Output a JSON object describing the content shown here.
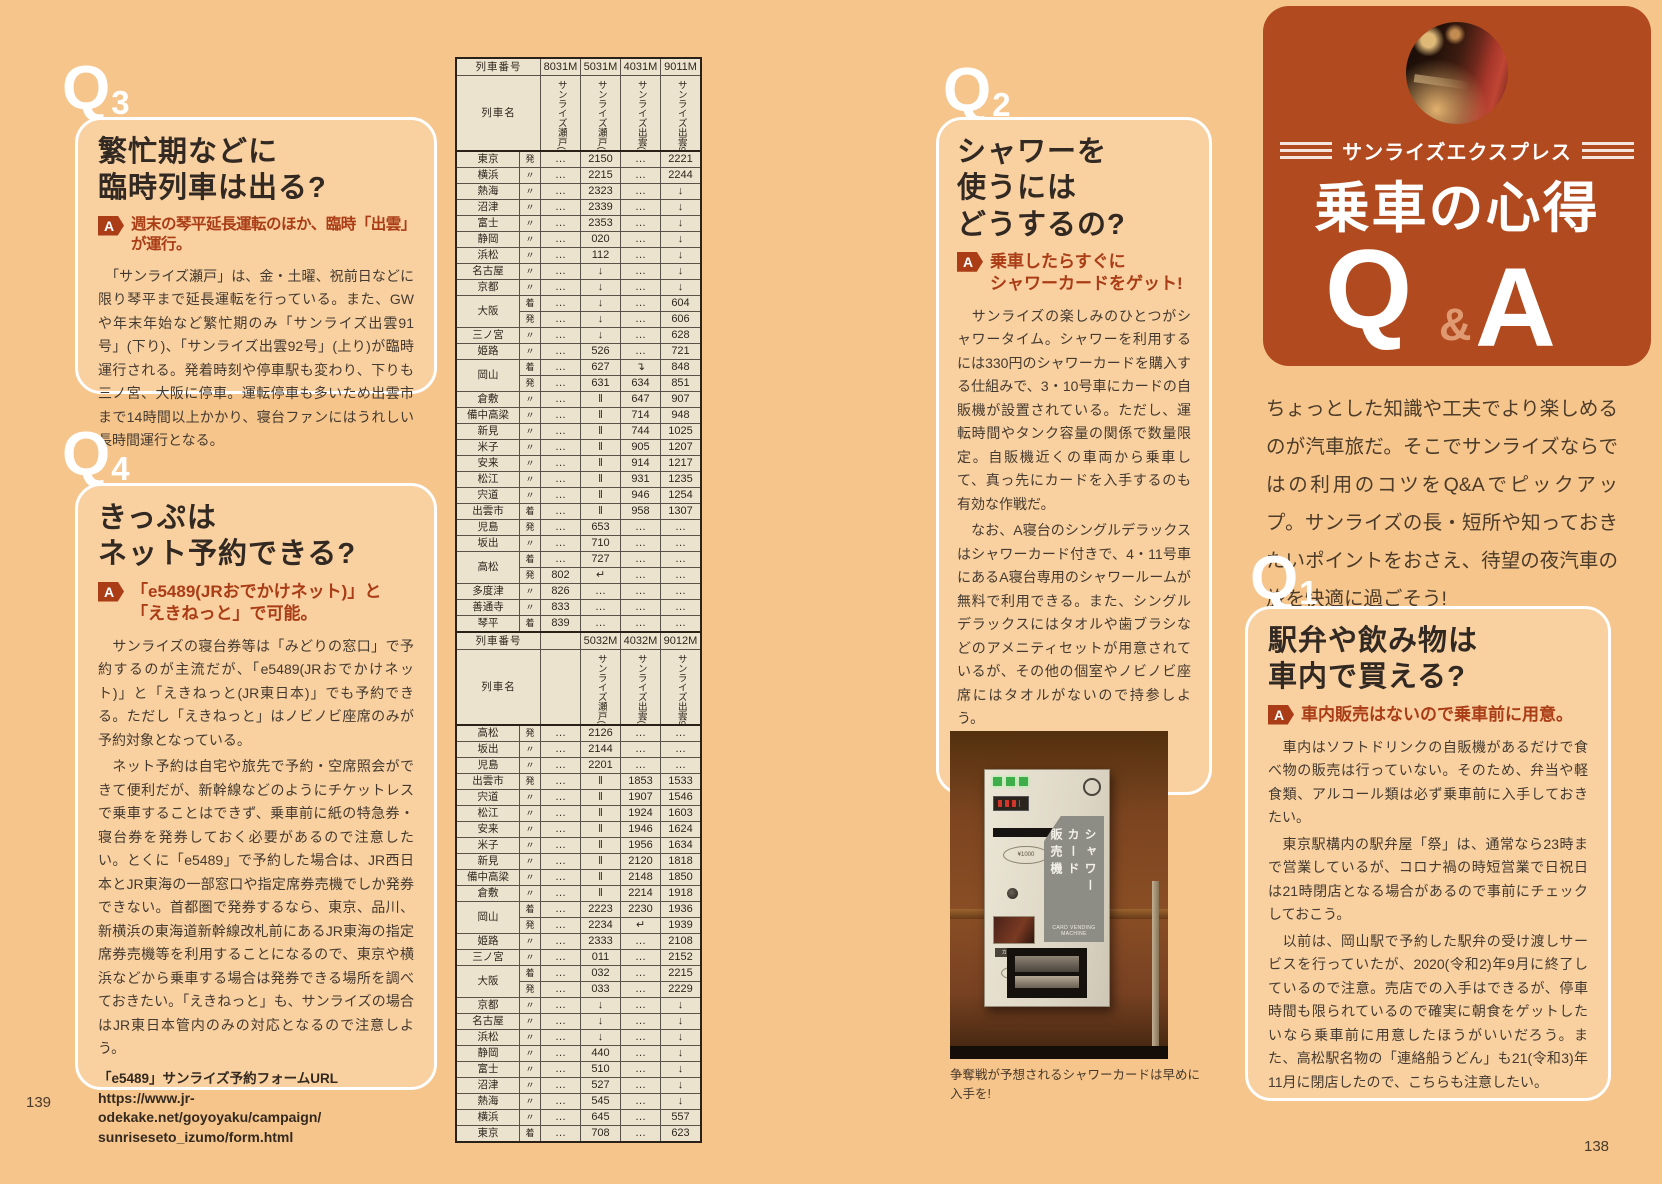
{
  "page": {
    "left_number": "139",
    "right_number": "138"
  },
  "masthead": {
    "subtitle": "サンライズエクスプレス",
    "title": "乗車の心得",
    "q": "Q",
    "amp": "&",
    "a": "A"
  },
  "intro": "ちょっとした知識や工夫でより楽しめるのが汽車旅だ。そこでサンライズならではの利用のコツをQ&Aでピックアップ。サンライズの長・短所や知っておきたいポイントをおさえ、待望の夜汽車の旅を快適に過ごそう!",
  "q1": {
    "marker": "Q",
    "number": "1",
    "title_lines": [
      "駅弁や飲み物は",
      "車内で買える?"
    ],
    "answer_label": "A",
    "answer": "車内販売はないので乗車前に用意。",
    "body": [
      "　車内はソフトドリンクの自販機があるだけで食べ物の販売は行っていない。そのため、弁当や軽食類、アルコール類は必ず乗車前に入手しておきたい。",
      "　東京駅構内の駅弁屋「祭」は、通常なら23時まで営業しているが、コロナ禍の時短営業で日祝日は21時閉店となる場合があるので事前にチェックしておこう。",
      "　以前は、岡山駅で予約した駅弁の受け渡しサービスを行っていたが、2020(令和2)年9月に終了しているので注意。売店での入手はできるが、停車時間も限られているので確実に朝食をゲットしたいなら乗車前に用意したほうがいいだろう。また、高松駅名物の「連絡船うどん」も21(令和3)年11月に閉店したので、こちらも注意したい。"
    ]
  },
  "q2": {
    "marker": "Q",
    "number": "2",
    "title_lines": [
      "シャワーを",
      "使うには",
      "どうするの?"
    ],
    "answer_label": "A",
    "answer_lines": [
      "乗車したらすぐに",
      "シャワーカードをゲット!"
    ],
    "body": [
      "　サンライズの楽しみのひとつがシャワータイム。シャワーを利用するには330円のシャワーカードを購入する仕組みで、3・10号車にカードの自販機が設置されている。ただし、運転時間やタンク容量の関係で数量限定。自販機近くの車両から乗車して、真っ先にカードを入手するのも有効な作戦だ。",
      "　なお、A寝台のシングルデラックスはシャワーカード付きで、4・11号車にあるA寝台専用のシャワールームが無料で利用できる。また、シングルデラックスにはタオルや歯ブラシなどのアメニティセットが用意されているが、その他の個室やノビノビ座席にはタオルがないので持参しよう。"
    ],
    "caption": "争奪戦が予想されるシャワーカードは早めに入手を!",
    "machine": {
      "labels": [
        "シャワー",
        "カード",
        "販売機"
      ],
      "sub": "CARD VENDING MACHINE",
      "bill_note": "¥1000",
      "outlet": "カード取出口",
      "card": "CARD"
    }
  },
  "q3": {
    "marker": "Q",
    "number": "3",
    "title_lines": [
      "繁忙期などに",
      "臨時列車は出る?"
    ],
    "answer_label": "A",
    "answer": "週末の琴平延長運転のほか、臨時「出雲」が運行。",
    "body": [
      "　「サンライズ瀬戸」は、金・土曜、祝前日などに限り琴平まで延長運転を行っている。また、GWや年末年始など繁忙期のみ「サンライズ出雲91号」(下り)、「サンライズ出雲92号」(上り)が臨時運行される。発着時刻や停車駅も変わり、下りも三ノ宮、大阪に停車。運転停車も多いため出雲市まで14時間以上かかり、寝台ファンにはうれしい長時間運行となる。"
    ]
  },
  "q4": {
    "marker": "Q",
    "number": "4",
    "title_lines": [
      "きっぷは",
      "ネット予約できる?"
    ],
    "answer_label": "A",
    "answer_lines": [
      "「e5489(JRおでかけネット)」と",
      "「えきねっと」で可能。"
    ],
    "body": [
      "　サンライズの寝台券等は「みどりの窓口」で予約するのが主流だが、「e5489(JRおでかけネット)」と「えきねっと(JR東日本)」でも予約できる。ただし「えきねっと」はノビノビ座席のみが予約対象となっている。",
      "　ネット予約は自宅や旅先で予約・空席照会ができて便利だが、新幹線などのようにチケットレスで乗車することはできず、乗車前に紙の特急券・寝台券を発券しておく必要があるので注意したい。とくに「e5489」で予約した場合は、JR西日本とJR東海の一部窓口や指定席券売機でしか発券できない。首都圏で発券するなら、東京、品川、新横浜の東海道新幹線改札前にあるJR東海の指定席券売機等を利用することになるので、東京や横浜などから乗車する場合は発券できる場所を調べておきたい。「えきねっと」も、サンライズの場合はJR東日本管内のみの対応となるので注意しよう。"
    ],
    "url_label": "「e5489」サンライズ予約フォームURL",
    "url_lines": [
      "https://www.jr-odekake.net/goyoyaku/campaign/",
      "sunriseseto_izumo/form.html"
    ]
  },
  "timetable": {
    "header_number_label": "列車番号",
    "header_name_label": "列車名",
    "down": {
      "numbers": [
        "8031M",
        "5031M",
        "4031M",
        "9011M"
      ],
      "names": [
        "サンライズ瀬戸(下り)",
        "サンライズ瀬戸(下り)",
        "サンライズ出雲(下り)",
        "サンライズ出雲91号"
      ],
      "rows": [
        {
          "station": "東京",
          "mark": "発",
          "cells": [
            "…",
            "2150",
            "…",
            "2221"
          ]
        },
        {
          "station": "横浜",
          "mark": "〃",
          "cells": [
            "…",
            "2215",
            "…",
            "2244"
          ]
        },
        {
          "station": "熱海",
          "mark": "〃",
          "cells": [
            "…",
            "2323",
            "…",
            "↓"
          ]
        },
        {
          "station": "沼津",
          "mark": "〃",
          "cells": [
            "…",
            "2339",
            "…",
            "↓"
          ]
        },
        {
          "station": "富士",
          "mark": "〃",
          "cells": [
            "…",
            "2353",
            "…",
            "↓"
          ]
        },
        {
          "station": "静岡",
          "mark": "〃",
          "cells": [
            "…",
            "020",
            "…",
            "↓"
          ]
        },
        {
          "station": "浜松",
          "mark": "〃",
          "cells": [
            "…",
            "112",
            "…",
            "↓"
          ]
        },
        {
          "station": "名古屋",
          "mark": "〃",
          "cells": [
            "…",
            "↓",
            "…",
            "↓"
          ]
        },
        {
          "station": "京都",
          "mark": "〃",
          "cells": [
            "…",
            "↓",
            "…",
            "↓"
          ]
        },
        {
          "station": "大阪",
          "span": 2,
          "mark": "着",
          "cells": [
            "…",
            "↓",
            "…",
            "604"
          ]
        },
        {
          "mark": "発",
          "cells": [
            "…",
            "↓",
            "…",
            "606"
          ]
        },
        {
          "station": "三ノ宮",
          "mark": "〃",
          "cells": [
            "…",
            "↓",
            "…",
            "628"
          ]
        },
        {
          "station": "姫路",
          "mark": "〃",
          "cells": [
            "…",
            "526",
            "…",
            "721"
          ]
        },
        {
          "station": "岡山",
          "span": 2,
          "mark": "着",
          "cells": [
            "…",
            "627",
            "↴",
            "848"
          ]
        },
        {
          "mark": "発",
          "cells": [
            "…",
            "631",
            "634",
            "851"
          ]
        },
        {
          "station": "倉敷",
          "mark": "〃",
          "cells": [
            "…",
            "‖",
            "647",
            "907"
          ]
        },
        {
          "station": "備中高梁",
          "mark": "〃",
          "cells": [
            "…",
            "‖",
            "714",
            "948"
          ]
        },
        {
          "station": "新見",
          "mark": "〃",
          "cells": [
            "…",
            "‖",
            "744",
            "1025"
          ]
        },
        {
          "station": "米子",
          "mark": "〃",
          "cells": [
            "…",
            "‖",
            "905",
            "1207"
          ]
        },
        {
          "station": "安来",
          "mark": "〃",
          "cells": [
            "…",
            "‖",
            "914",
            "1217"
          ]
        },
        {
          "station": "松江",
          "mark": "〃",
          "cells": [
            "…",
            "‖",
            "931",
            "1235"
          ]
        },
        {
          "station": "宍道",
          "mark": "〃",
          "cells": [
            "…",
            "‖",
            "946",
            "1254"
          ]
        },
        {
          "station": "出雲市",
          "mark": "着",
          "cells": [
            "…",
            "‖",
            "958",
            "1307"
          ]
        },
        {
          "station": "児島",
          "mark": "発",
          "cells": [
            "…",
            "653",
            "…",
            "…"
          ]
        },
        {
          "station": "坂出",
          "mark": "〃",
          "cells": [
            "…",
            "710",
            "…",
            "…"
          ]
        },
        {
          "station": "高松",
          "span": 2,
          "mark": "着",
          "cells": [
            "…",
            "727",
            "…",
            "…"
          ]
        },
        {
          "mark": "発",
          "cells": [
            "802",
            "↵",
            "…",
            "…"
          ]
        },
        {
          "station": "多度津",
          "mark": "〃",
          "cells": [
            "826",
            "…",
            "…",
            "…"
          ]
        },
        {
          "station": "善通寺",
          "mark": "〃",
          "cells": [
            "833",
            "…",
            "…",
            "…"
          ]
        },
        {
          "station": "琴平",
          "mark": "着",
          "cells": [
            "839",
            "…",
            "…",
            "…"
          ]
        }
      ]
    },
    "up": {
      "numbers": [
        "",
        "5032M",
        "4032M",
        "9012M"
      ],
      "names": [
        "",
        "サンライズ瀬戸(上り)",
        "サンライズ出雲(上り)",
        "サンライズ出雲92号"
      ],
      "rows": [
        {
          "station": "高松",
          "mark": "発",
          "cells": [
            "…",
            "2126",
            "…",
            "…"
          ]
        },
        {
          "station": "坂出",
          "mark": "〃",
          "cells": [
            "…",
            "2144",
            "…",
            "…"
          ]
        },
        {
          "station": "児島",
          "mark": "〃",
          "cells": [
            "…",
            "2201",
            "…",
            "…"
          ]
        },
        {
          "station": "出雲市",
          "mark": "発",
          "cells": [
            "…",
            "‖",
            "1853",
            "1533"
          ]
        },
        {
          "station": "宍道",
          "mark": "〃",
          "cells": [
            "…",
            "‖",
            "1907",
            "1546"
          ]
        },
        {
          "station": "松江",
          "mark": "〃",
          "cells": [
            "…",
            "‖",
            "1924",
            "1603"
          ]
        },
        {
          "station": "安来",
          "mark": "〃",
          "cells": [
            "…",
            "‖",
            "1946",
            "1624"
          ]
        },
        {
          "station": "米子",
          "mark": "〃",
          "cells": [
            "…",
            "‖",
            "1956",
            "1634"
          ]
        },
        {
          "station": "新見",
          "mark": "〃",
          "cells": [
            "…",
            "‖",
            "2120",
            "1818"
          ]
        },
        {
          "station": "備中高梁",
          "mark": "〃",
          "cells": [
            "…",
            "‖",
            "2148",
            "1850"
          ]
        },
        {
          "station": "倉敷",
          "mark": "〃",
          "cells": [
            "…",
            "‖",
            "2214",
            "1918"
          ]
        },
        {
          "station": "岡山",
          "span": 2,
          "mark": "着",
          "cells": [
            "…",
            "2223",
            "2230",
            "1936"
          ]
        },
        {
          "mark": "発",
          "cells": [
            "…",
            "2234",
            "↵",
            "1939"
          ]
        },
        {
          "station": "姫路",
          "mark": "〃",
          "cells": [
            "…",
            "2333",
            "…",
            "2108"
          ]
        },
        {
          "station": "三ノ宮",
          "mark": "〃",
          "cells": [
            "…",
            "011",
            "…",
            "2152"
          ]
        },
        {
          "station": "大阪",
          "span": 2,
          "mark": "着",
          "cells": [
            "…",
            "032",
            "…",
            "2215"
          ]
        },
        {
          "mark": "発",
          "cells": [
            "…",
            "033",
            "…",
            "2229"
          ]
        },
        {
          "station": "京都",
          "mark": "〃",
          "cells": [
            "…",
            "↓",
            "…",
            "↓"
          ]
        },
        {
          "station": "名古屋",
          "mark": "〃",
          "cells": [
            "…",
            "↓",
            "…",
            "↓"
          ]
        },
        {
          "station": "浜松",
          "mark": "〃",
          "cells": [
            "…",
            "↓",
            "…",
            "↓"
          ]
        },
        {
          "station": "静岡",
          "mark": "〃",
          "cells": [
            "…",
            "440",
            "…",
            "↓"
          ]
        },
        {
          "station": "富士",
          "mark": "〃",
          "cells": [
            "…",
            "510",
            "…",
            "↓"
          ]
        },
        {
          "station": "沼津",
          "mark": "〃",
          "cells": [
            "…",
            "527",
            "…",
            "↓"
          ]
        },
        {
          "station": "熱海",
          "mark": "〃",
          "cells": [
            "…",
            "545",
            "…",
            "↓"
          ]
        },
        {
          "station": "横浜",
          "mark": "〃",
          "cells": [
            "…",
            "645",
            "…",
            "557"
          ]
        },
        {
          "station": "東京",
          "mark": "着",
          "cells": [
            "…",
            "708",
            "…",
            "623"
          ]
        }
      ]
    }
  }
}
